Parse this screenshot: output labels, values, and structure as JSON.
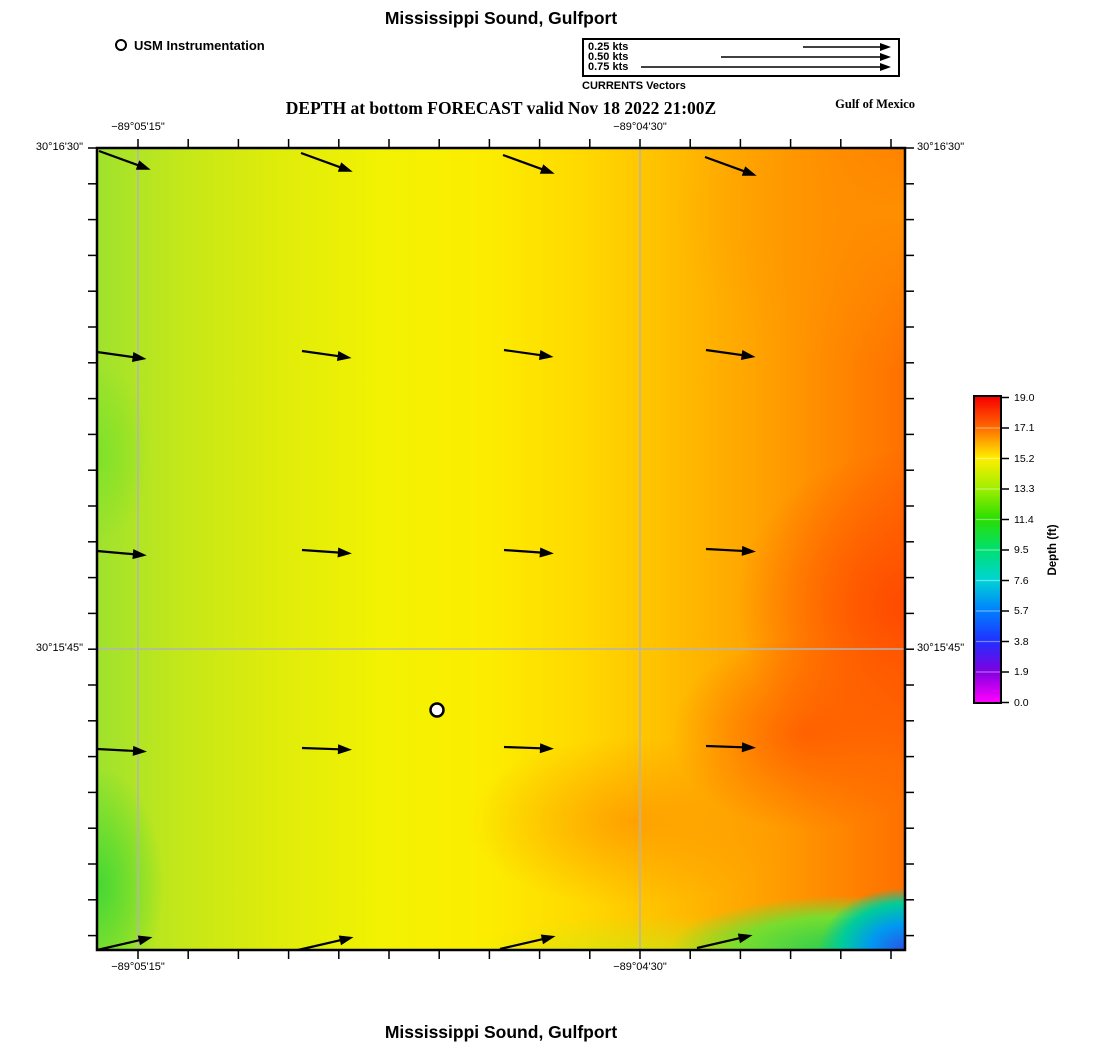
{
  "header": {
    "title": "Mississippi Sound, Gulfport",
    "subtitle": "DEPTH at bottom FORECAST valid Nov 18 2022 21:00Z",
    "region": "Gulf of Mexico"
  },
  "footer": {
    "title": "Mississippi Sound, Gulfport"
  },
  "station_legend": {
    "label": "USM Instrumentation"
  },
  "vector_legend": {
    "caption": "CURRENTS Vectors",
    "items": [
      {
        "label": "0.25 kts",
        "len": 88
      },
      {
        "label": "0.50 kts",
        "len": 170
      },
      {
        "label": "0.75 kts",
        "len": 250
      }
    ]
  },
  "axes": {
    "top": [
      {
        "text": "−89°05'15\"",
        "x": 138
      },
      {
        "text": "−89°04'30\"",
        "x": 640
      }
    ],
    "bottom": [
      {
        "text": "−89°05'15\"",
        "x": 138
      },
      {
        "text": "−89°04'30\"",
        "x": 640
      }
    ],
    "left": [
      {
        "text": "30°16'30\"",
        "y": 148
      },
      {
        "text": "30°15'45\"",
        "y": 649
      }
    ],
    "right": [
      {
        "text": "30°16'30\"",
        "y": 148
      },
      {
        "text": "30°15'45\"",
        "y": 649
      }
    ]
  },
  "colorbar": {
    "label": "Depth (ft)",
    "ticks": [
      "19.0",
      "17.1",
      "15.2",
      "13.3",
      "11.4",
      "9.5",
      "7.6",
      "5.7",
      "3.8",
      "1.9",
      "0.0"
    ],
    "stops": [
      {
        "p": "0%",
        "c": "#f80000"
      },
      {
        "p": "10%",
        "c": "#ff6a00"
      },
      {
        "p": "20%",
        "c": "#ffee00"
      },
      {
        "p": "30%",
        "c": "#a0ee00"
      },
      {
        "p": "40%",
        "c": "#2ade00"
      },
      {
        "p": "50%",
        "c": "#00e070"
      },
      {
        "p": "60%",
        "c": "#00d4d4"
      },
      {
        "p": "70%",
        "c": "#0080ff"
      },
      {
        "p": "80%",
        "c": "#2030ff"
      },
      {
        "p": "90%",
        "c": "#8000e0"
      },
      {
        "p": "100%",
        "c": "#ff00ff"
      }
    ]
  },
  "map": {
    "frame": {
      "x": 97,
      "y": 148,
      "w": 808,
      "h": 802
    },
    "gridlines": {
      "vx": [
        138,
        640
      ],
      "hy": [
        649
      ],
      "color": "#b4b4b4"
    },
    "marker": {
      "x": 437,
      "y": 710,
      "r": 6.5
    },
    "arrows": [
      {
        "x": 99,
        "y": 151,
        "len": 55,
        "ang": 20
      },
      {
        "x": 301,
        "y": 153,
        "len": 55,
        "ang": 20
      },
      {
        "x": 503,
        "y": 155,
        "len": 55,
        "ang": 20
      },
      {
        "x": 705,
        "y": 157,
        "len": 55,
        "ang": 20
      },
      {
        "x": 97,
        "y": 352,
        "len": 50,
        "ang": 8
      },
      {
        "x": 302,
        "y": 351,
        "len": 50,
        "ang": 8
      },
      {
        "x": 504,
        "y": 350,
        "len": 50,
        "ang": 8
      },
      {
        "x": 706,
        "y": 350,
        "len": 50,
        "ang": 8
      },
      {
        "x": 97,
        "y": 551,
        "len": 50,
        "ang": 5
      },
      {
        "x": 302,
        "y": 550,
        "len": 50,
        "ang": 4
      },
      {
        "x": 504,
        "y": 550,
        "len": 50,
        "ang": 4
      },
      {
        "x": 706,
        "y": 549,
        "len": 50,
        "ang": 3
      },
      {
        "x": 97,
        "y": 749,
        "len": 50,
        "ang": 3
      },
      {
        "x": 302,
        "y": 748,
        "len": 50,
        "ang": 2
      },
      {
        "x": 504,
        "y": 747,
        "len": 50,
        "ang": 2
      },
      {
        "x": 706,
        "y": 746,
        "len": 50,
        "ang": 2
      },
      {
        "x": 97,
        "y": 950,
        "len": 57,
        "ang": -13
      },
      {
        "x": 298,
        "y": 950,
        "len": 57,
        "ang": -13
      },
      {
        "x": 500,
        "y": 949,
        "len": 57,
        "ang": -13
      },
      {
        "x": 697,
        "y": 948,
        "len": 57,
        "ang": -13
      }
    ],
    "ticks": {
      "x_start": 41,
      "x_step": 50.2,
      "x_count": 16,
      "y_start": 0,
      "y_step": 35.8,
      "y_count": 23
    }
  },
  "chart_data": {
    "type": "heatmap",
    "title": "Mississippi Sound, Gulfport",
    "subtitle": "DEPTH at bottom FORECAST valid Nov 18 2022 21:00Z",
    "annotations": [
      "Gulf of Mexico",
      "CURRENTS Vectors",
      "USM Instrumentation"
    ],
    "x_axis": {
      "label": "longitude",
      "tick_labels": [
        "−89°05'15\"",
        "−89°04'30\""
      ]
    },
    "y_axis": {
      "label": "latitude",
      "tick_labels": [
        "30°16'30\"",
        "30°15'45\""
      ]
    },
    "colorbar": {
      "label": "Depth (ft)",
      "min": 0.0,
      "max": 19.0,
      "tick_values": [
        19.0,
        17.1,
        15.2,
        13.3,
        11.4,
        9.5,
        7.6,
        5.7,
        3.8,
        1.9,
        0.0
      ]
    },
    "field_summary": "Depth ~13–14 ft (yellow-green) along west edge, ~15 ft (yellow) mid-domain, rising to ~17–19 ft (orange-red) along the east side; shallow pocket 0–10 ft (green-cyan-blue) in the far southeast corner.",
    "vector_field": {
      "legend_speeds_kts": [
        0.25,
        0.5,
        0.75
      ],
      "description": "4×5 grid of current vectors, all pointing eastward (~0.15 kts); top row tilted slightly down-coast, bottom row tilted slightly up."
    },
    "station": {
      "name": "USM Instrumentation",
      "lon_px": 437,
      "lat_px": 710
    }
  }
}
